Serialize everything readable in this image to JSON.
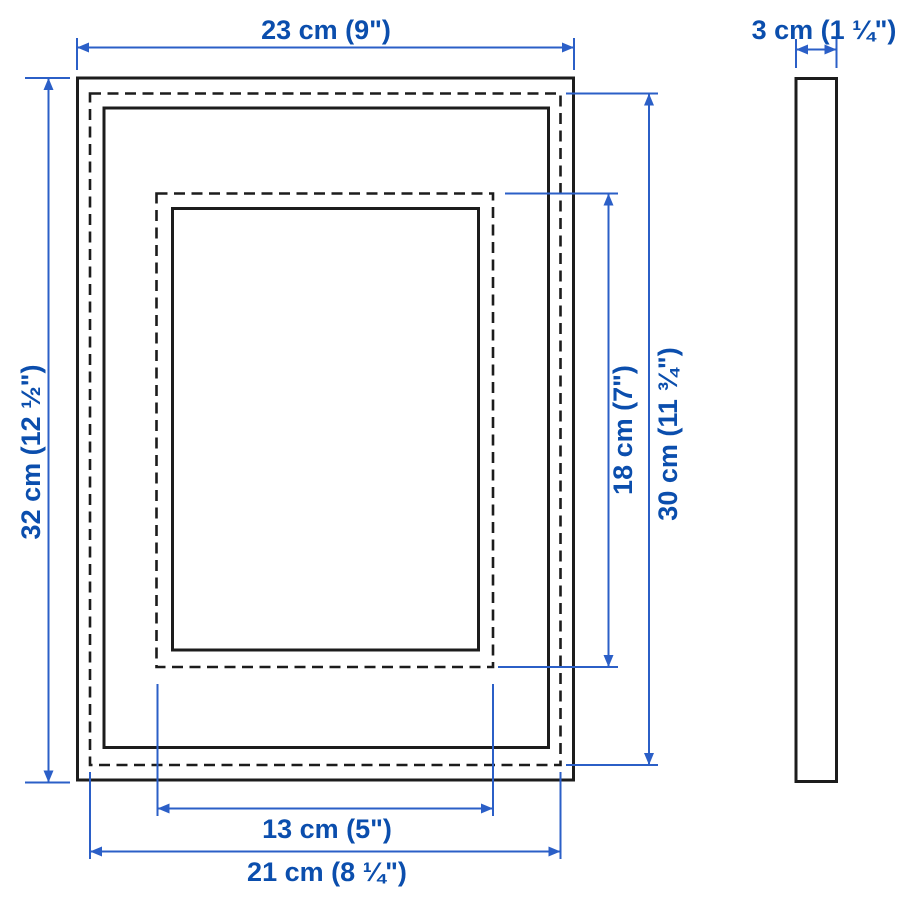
{
  "diagram": {
    "title": "Picture frame dimensions diagram",
    "views": [
      {
        "name": "front view"
      },
      {
        "name": "side view"
      }
    ],
    "dimensions": {
      "frame_width": {
        "label": "23 cm (9\")"
      },
      "frame_depth": {
        "label": "3 cm (1 ¼\")"
      },
      "frame_height": {
        "label": "32 cm (12 ½\")"
      },
      "back_height": {
        "label": "30 cm (11 ¾\")"
      },
      "picture_height": {
        "label": "18 cm (7\")"
      },
      "picture_width": {
        "label": "13 cm (5\")"
      },
      "back_width": {
        "label": "21 cm (8 ¼\")"
      }
    },
    "colors": {
      "outline": "#1c1c1c",
      "dimension_line": "#2b5fc7",
      "dimension_text": "#0b4ead",
      "background": "#ffffff"
    }
  }
}
